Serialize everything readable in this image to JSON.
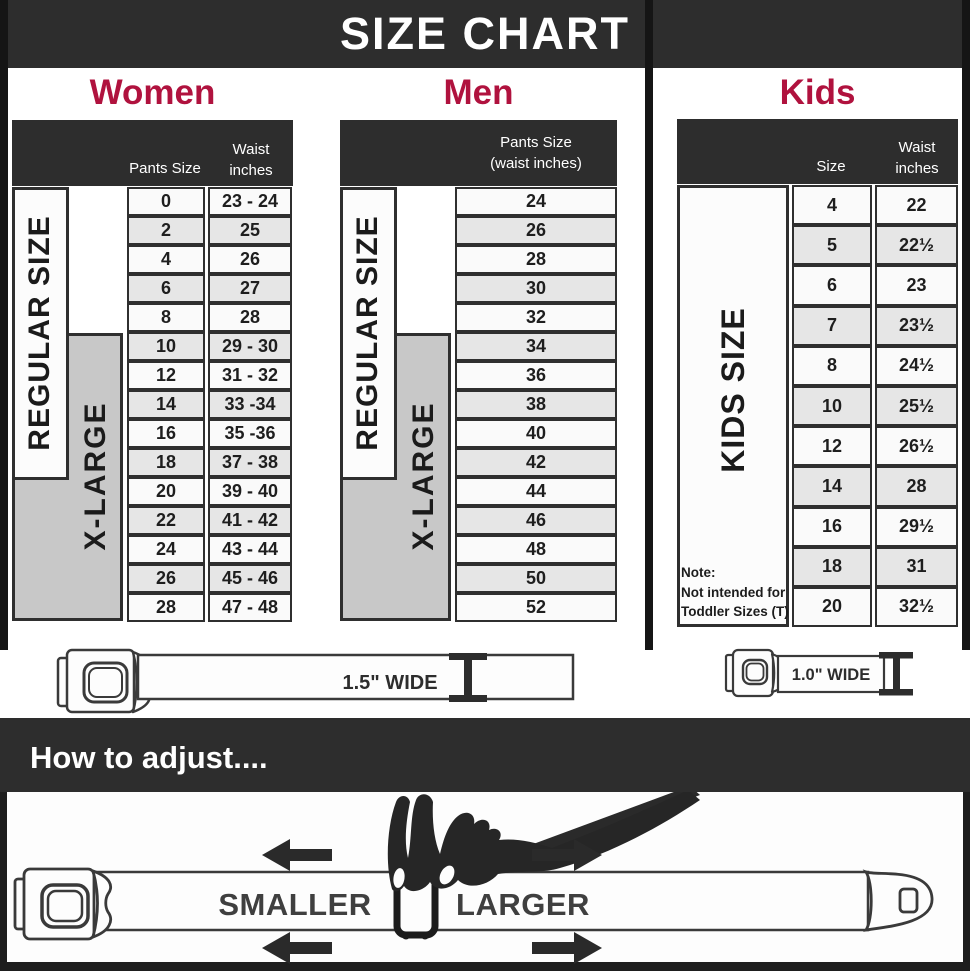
{
  "title": "SIZE CHART",
  "colors": {
    "bar_dark": "#2d2d2d",
    "accent_crimson": "#b0123e",
    "xlarge_grey": "#c8c8c8"
  },
  "women": {
    "title": "Women",
    "col1_header": "Pants Size",
    "col2_header_line1": "Waist",
    "col2_header_line2": "inches",
    "regular_label": "REGULAR SIZE",
    "xlarge_label": "X-LARGE",
    "rows": [
      {
        "size": "0",
        "waist": "23 - 24"
      },
      {
        "size": "2",
        "waist": "25"
      },
      {
        "size": "4",
        "waist": "26"
      },
      {
        "size": "6",
        "waist": "27"
      },
      {
        "size": "8",
        "waist": "28"
      },
      {
        "size": "10",
        "waist": "29 - 30"
      },
      {
        "size": "12",
        "waist": "31 - 32"
      },
      {
        "size": "14",
        "waist": "33 -34"
      },
      {
        "size": "16",
        "waist": "35 -36"
      },
      {
        "size": "18",
        "waist": "37 - 38"
      },
      {
        "size": "20",
        "waist": "39 - 40"
      },
      {
        "size": "22",
        "waist": "41 - 42"
      },
      {
        "size": "24",
        "waist": "43 - 44"
      },
      {
        "size": "26",
        "waist": "45 - 46"
      },
      {
        "size": "28",
        "waist": "47 - 48"
      }
    ]
  },
  "men": {
    "title": "Men",
    "header_line1": "Pants Size",
    "header_line2": "(waist inches)",
    "regular_label": "REGULAR SIZE",
    "xlarge_label": "X-LARGE",
    "rows": [
      "24",
      "26",
      "28",
      "30",
      "32",
      "34",
      "36",
      "38",
      "40",
      "42",
      "44",
      "46",
      "48",
      "50",
      "52"
    ]
  },
  "kids": {
    "title": "Kids",
    "col1_header": "Size",
    "col2_header_line1": "Waist",
    "col2_header_line2": "inches",
    "side_label": "KIDS SIZE",
    "note_lines": [
      "Note:",
      "Not intended for",
      "Toddler Sizes (T)"
    ],
    "rows": [
      {
        "size": "4",
        "waist": "22"
      },
      {
        "size": "5",
        "waist": "22½"
      },
      {
        "size": "6",
        "waist": "23"
      },
      {
        "size": "7",
        "waist": "23½"
      },
      {
        "size": "8",
        "waist": "24½"
      },
      {
        "size": "10",
        "waist": "25½"
      },
      {
        "size": "12",
        "waist": "26½"
      },
      {
        "size": "14",
        "waist": "28"
      },
      {
        "size": "16",
        "waist": "29½"
      },
      {
        "size": "18",
        "waist": "31"
      },
      {
        "size": "20",
        "waist": "32½"
      }
    ]
  },
  "belts": {
    "adult_width_label": "1.5\" WIDE",
    "kids_width_label": "1.0\" WIDE"
  },
  "adjust": {
    "heading": "How to adjust....",
    "smaller_label": "SMALLER",
    "larger_label": "LARGER"
  },
  "chart_data": [
    {
      "type": "table",
      "title": "Women belt sizes",
      "columns": [
        "Pants Size",
        "Waist inches"
      ],
      "rows": [
        [
          "0",
          "23 - 24"
        ],
        [
          "2",
          "25"
        ],
        [
          "4",
          "26"
        ],
        [
          "6",
          "27"
        ],
        [
          "8",
          "28"
        ],
        [
          "10",
          "29 - 30"
        ],
        [
          "12",
          "31 - 32"
        ],
        [
          "14",
          "33 -34"
        ],
        [
          "16",
          "35 -36"
        ],
        [
          "18",
          "37 - 38"
        ],
        [
          "20",
          "39 - 40"
        ],
        [
          "22",
          "41 - 42"
        ],
        [
          "24",
          "43 - 44"
        ],
        [
          "26",
          "45 - 46"
        ],
        [
          "28",
          "47 - 48"
        ]
      ],
      "annotations": [
        "REGULAR SIZE spans 0-18",
        "X-LARGE spans 10-28",
        "belt width 1.5\""
      ]
    },
    {
      "type": "table",
      "title": "Men belt sizes",
      "columns": [
        "Pants Size (waist inches)"
      ],
      "rows": [
        [
          "24"
        ],
        [
          "26"
        ],
        [
          "28"
        ],
        [
          "30"
        ],
        [
          "32"
        ],
        [
          "34"
        ],
        [
          "36"
        ],
        [
          "38"
        ],
        [
          "40"
        ],
        [
          "42"
        ],
        [
          "44"
        ],
        [
          "46"
        ],
        [
          "48"
        ],
        [
          "50"
        ],
        [
          "52"
        ]
      ],
      "annotations": [
        "REGULAR SIZE spans 24-42",
        "X-LARGE spans 34-52",
        "belt width 1.5\""
      ]
    },
    {
      "type": "table",
      "title": "Kids belt sizes",
      "columns": [
        "Size",
        "Waist inches"
      ],
      "rows": [
        [
          "4",
          "22"
        ],
        [
          "5",
          "22½"
        ],
        [
          "6",
          "23"
        ],
        [
          "7",
          "23½"
        ],
        [
          "8",
          "24½"
        ],
        [
          "10",
          "25½"
        ],
        [
          "12",
          "26½"
        ],
        [
          "14",
          "28"
        ],
        [
          "16",
          "29½"
        ],
        [
          "18",
          "31"
        ],
        [
          "20",
          "32½"
        ]
      ],
      "annotations": [
        "KIDS SIZE",
        "Note: Not intended for Toddler Sizes (T)",
        "belt width 1.0\""
      ]
    }
  ]
}
